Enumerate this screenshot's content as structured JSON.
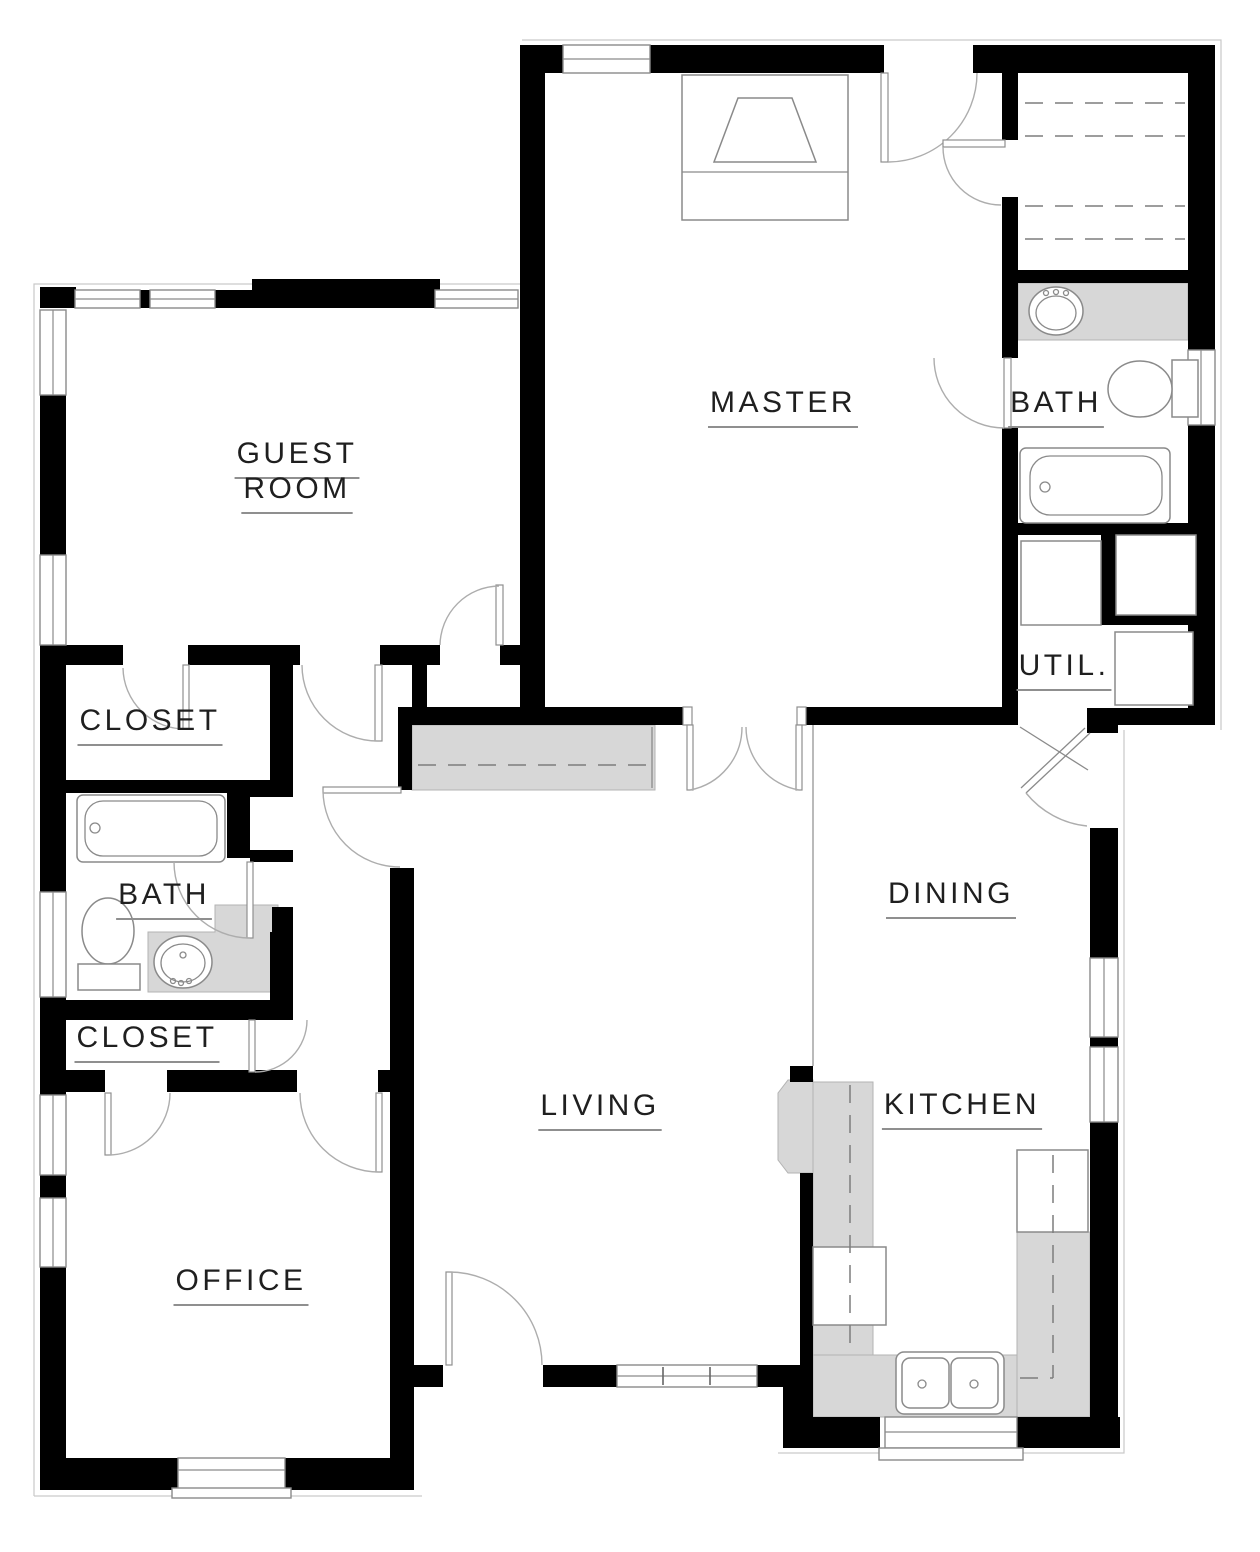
{
  "title": "3-bedroom house floor plan",
  "colors": {
    "wall": "#000000",
    "counter": "#d7d7d7",
    "counter_edge": "#b3b3b3",
    "fixture_line": "#8a8a8a",
    "eave_line": "#c9c9c9",
    "label": "#1f1f1f",
    "underline": "#8f8f8f"
  },
  "rooms": [
    {
      "id": "guest-room-1",
      "label": "GUEST",
      "x": 297,
      "y": 452
    },
    {
      "id": "guest-room-2",
      "label": "ROOM",
      "x": 297,
      "y": 487
    },
    {
      "id": "master",
      "label": "MASTER",
      "x": 783,
      "y": 401
    },
    {
      "id": "bath-right",
      "label": "BATH",
      "x": 1056,
      "y": 401
    },
    {
      "id": "util",
      "label": "UTIL.",
      "x": 1064,
      "y": 664
    },
    {
      "id": "closet-upper",
      "label": "CLOSET",
      "x": 150,
      "y": 719
    },
    {
      "id": "bath-left",
      "label": "BATH",
      "x": 164,
      "y": 893
    },
    {
      "id": "closet-lower",
      "label": "CLOSET",
      "x": 147,
      "y": 1036
    },
    {
      "id": "dining",
      "label": "DINING",
      "x": 951,
      "y": 892
    },
    {
      "id": "living",
      "label": "LIVING",
      "x": 600,
      "y": 1104
    },
    {
      "id": "kitchen",
      "label": "KITCHEN",
      "x": 962,
      "y": 1103
    },
    {
      "id": "office",
      "label": "OFFICE",
      "x": 241,
      "y": 1279
    }
  ],
  "fixtures": [
    "bed",
    "wardrobe-shelves",
    "vanity-sink",
    "toilet",
    "bathtub",
    "washer",
    "dryer",
    "water-heater",
    "closet-rod",
    "refrigerator",
    "range",
    "double-kitchen-sink"
  ]
}
